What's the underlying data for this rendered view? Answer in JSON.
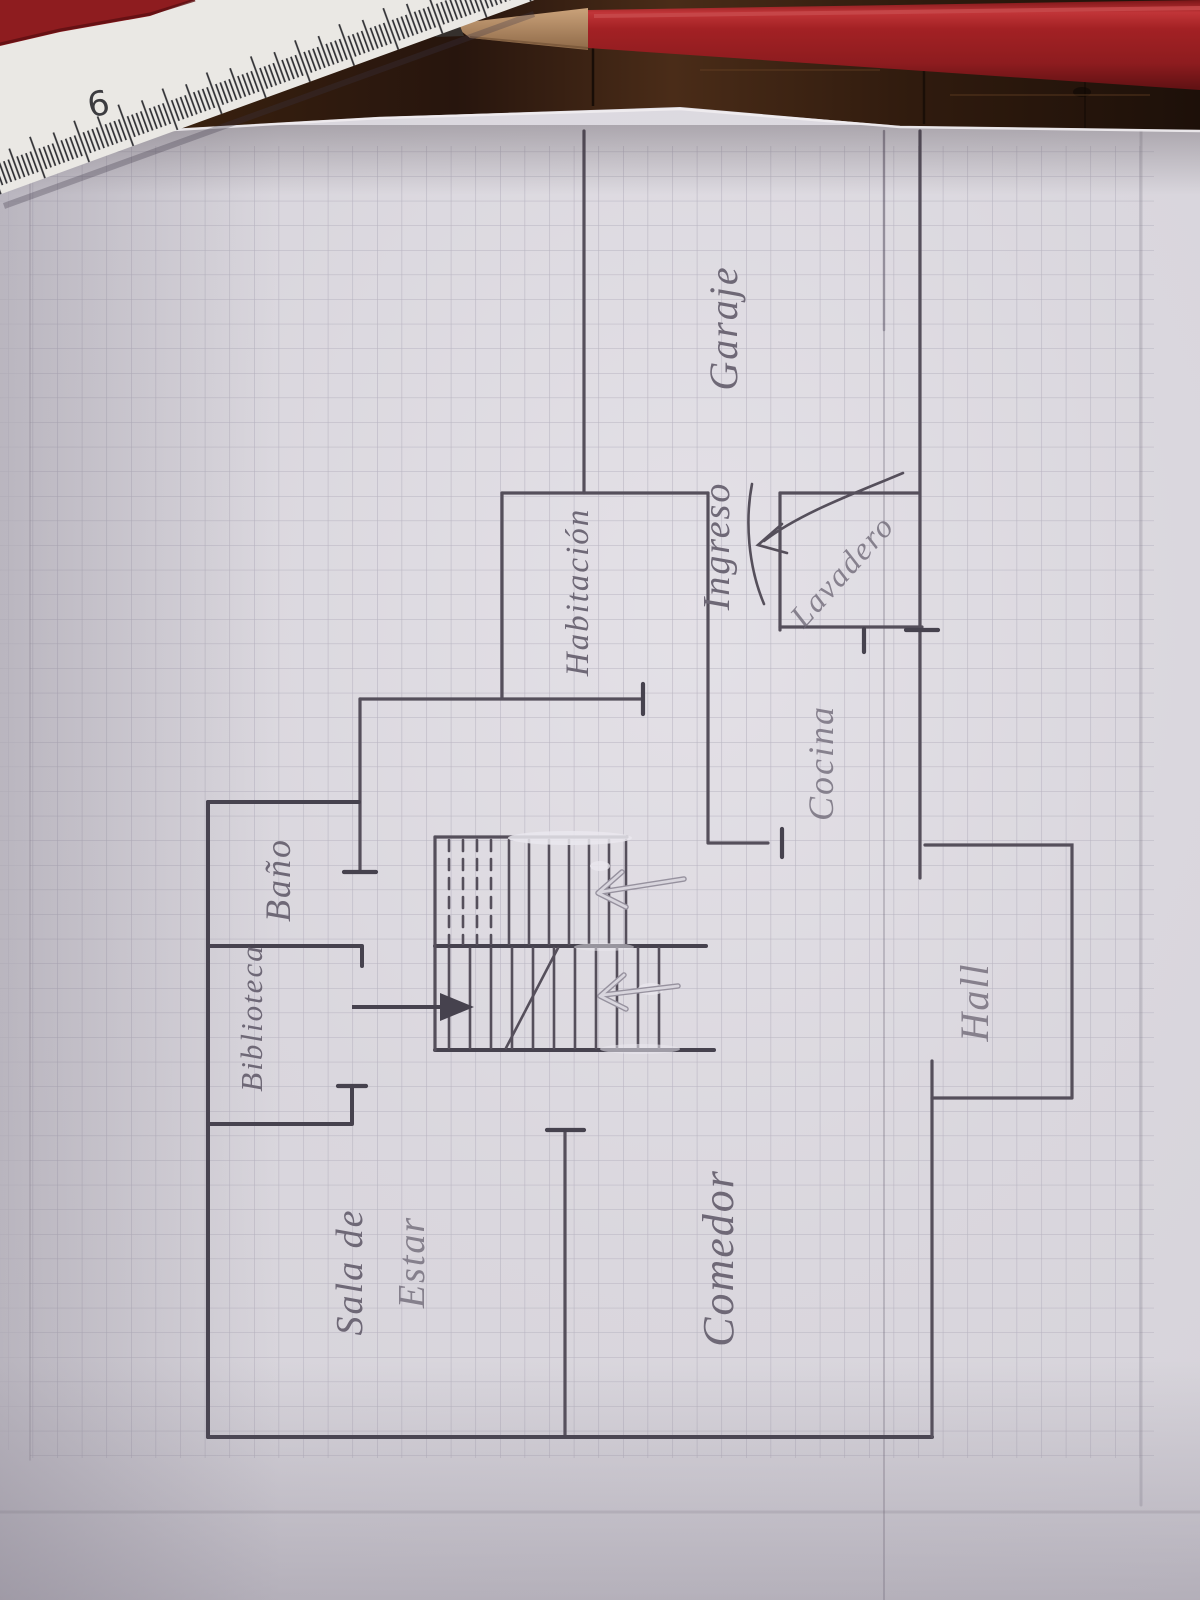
{
  "photo": {
    "surface": {
      "ruler_numbers": [
        "6",
        "8"
      ]
    },
    "floor_plan": {
      "rooms": [
        {
          "id": "garaje",
          "label": "Garaje"
        },
        {
          "id": "ingreso",
          "label": "Ingreso"
        },
        {
          "id": "lavadero",
          "label": "Lavadero"
        },
        {
          "id": "habitacion",
          "label": "Habitación"
        },
        {
          "id": "cocina",
          "label": "Cocina"
        },
        {
          "id": "bano",
          "label": "Baño"
        },
        {
          "id": "biblioteca",
          "label": "Biblioteca"
        },
        {
          "id": "sala-de-estar",
          "label_line1": "Sala de",
          "label_line2": "Estar"
        },
        {
          "id": "comedor",
          "label": "Comedor"
        },
        {
          "id": "hall",
          "label": "Hall"
        }
      ]
    },
    "colors": {
      "paper": "#d6d3da",
      "paper_bright": "#e3e0e6",
      "grid": "#b7b3c0",
      "pencil_line": "#554f5b",
      "pencil_dark": "#46424e",
      "label_ink": "#6e6876",
      "wood_dark": "#24140c",
      "wood_mid": "#4a2c18",
      "pencil_red": "#9b1d20",
      "pencil_red_highlight": "#c84a4c",
      "ruler_white": "#eae8e4",
      "whiteout": "#eae7ee"
    }
  }
}
